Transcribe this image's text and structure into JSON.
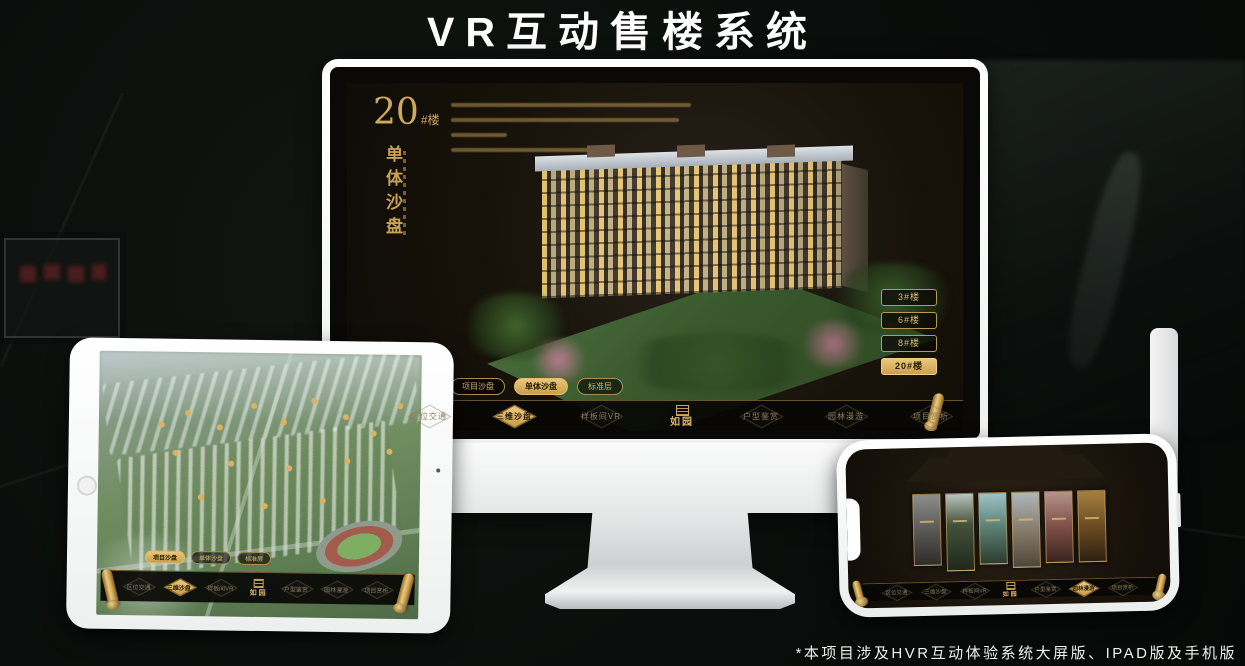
{
  "banner": {
    "title": "VR互动售楼系统"
  },
  "footnote": "*本项目涉及HVR互动体验系统大屏版、IPAD版及手机版",
  "colors": {
    "gold": "#d2a855",
    "gold_bright": "#ecc778",
    "active_text": "#241a08",
    "screen_bg": "#17120a",
    "title_text": "#ffffff"
  },
  "desktop": {
    "block_number": "20",
    "block_suffix": "#楼",
    "section_title": "单体沙盘",
    "floor_buttons": [
      {
        "label": "3#楼",
        "active": false
      },
      {
        "label": "6#楼",
        "active": false
      },
      {
        "label": "8#楼",
        "active": false
      },
      {
        "label": "20#楼",
        "active": true
      }
    ],
    "sub_tabs": [
      {
        "label": "项目沙盘",
        "active": false
      },
      {
        "label": "单体沙盘",
        "active": true
      },
      {
        "label": "标准层",
        "active": false
      }
    ],
    "nav": {
      "items_left": [
        "区位交通",
        "三维沙盘",
        "样板间VR"
      ],
      "logo": "如园",
      "items_right": [
        "户型鉴赏",
        "园林漫游",
        "项目赏析"
      ],
      "active_item": "三维沙盘"
    }
  },
  "tablet": {
    "sub_tabs": [
      {
        "label": "项目沙盘",
        "active": true
      },
      {
        "label": "单体沙盘",
        "active": false
      },
      {
        "label": "标准层",
        "active": false
      }
    ],
    "nav": {
      "items_left": [
        "区位交通",
        "三维沙盘",
        "样板间VR"
      ],
      "logo": "如园",
      "items_right": [
        "户型鉴赏",
        "园林漫游",
        "项目赏析"
      ],
      "active_item": "三维沙盘"
    }
  },
  "phone": {
    "nav": {
      "items_left": [
        "区位交通",
        "三维沙盘",
        "样板间VR"
      ],
      "logo": "如园",
      "items_right": [
        "户型鉴赏",
        "园林漫游",
        "项目赏析"
      ],
      "active_item": "园林漫游"
    }
  }
}
